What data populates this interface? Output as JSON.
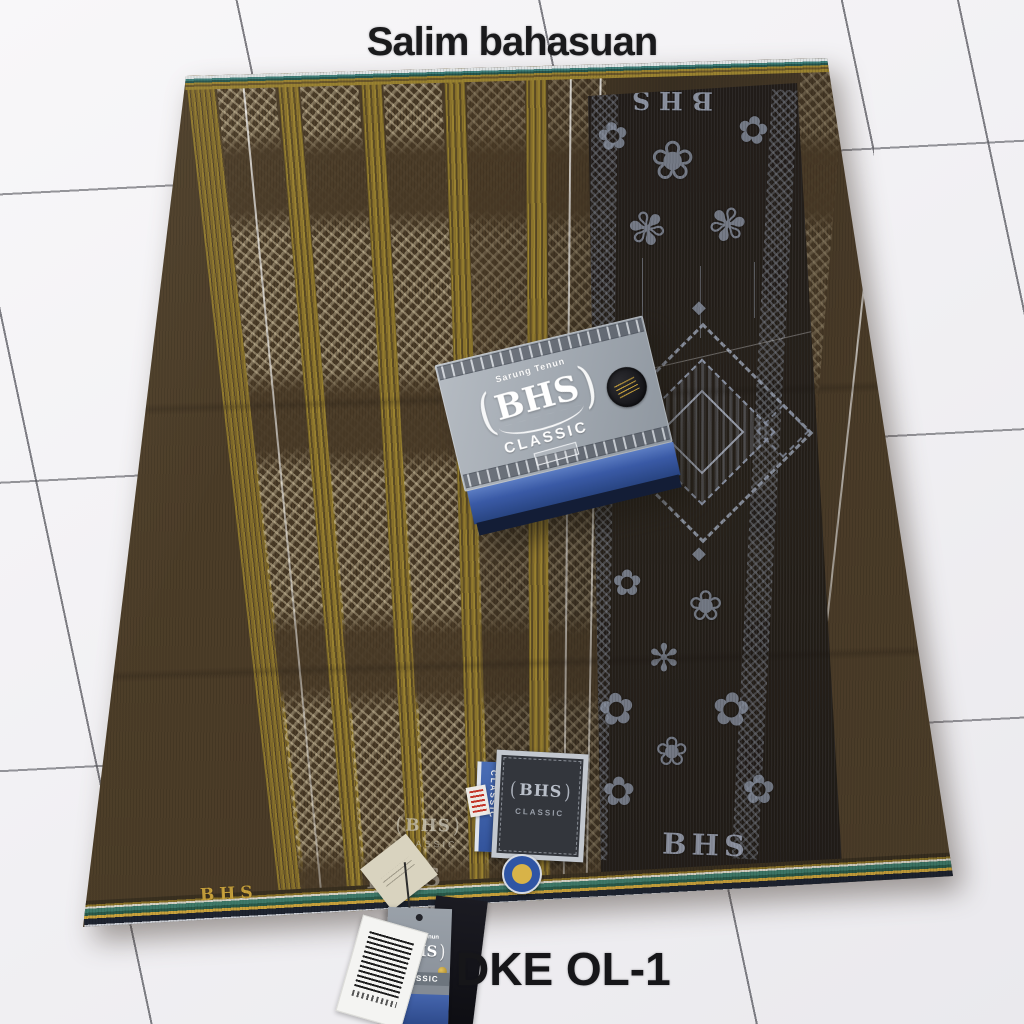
{
  "captions": {
    "top": "Salim bahasuan",
    "bottom": "DKE OL-1"
  },
  "box": {
    "tagline": "Sarung Tenun",
    "brand": "BHS",
    "line": "CLASSIC"
  },
  "fabric": {
    "panel_brand_top": "BHS",
    "panel_brand_bottom": "BHS",
    "selvage_brand": "BHS",
    "emblem": {
      "brand": "BHS",
      "line": "CLASSIC"
    },
    "emblem2_brand": "BHS",
    "label_tag": {
      "brand": "BHS",
      "line": "CLASSIC"
    }
  },
  "tags": {
    "blue_tag": {
      "line": "CLASSIC"
    },
    "hang_tag": {
      "tagline": "Sarung Tenun",
      "brand": "BHS",
      "line": "CLASSIC"
    }
  },
  "colors": {
    "fabric_brown": "#4a3b27",
    "stripe_gold": "#9a8230",
    "panel_black": "#241f1b",
    "panel_silver": "#99a1b2",
    "box_gray": "#a4abb3",
    "box_blue": "#3a5aa6",
    "accent_gold": "#c9a23c",
    "floor_white": "#f2f1f4"
  }
}
